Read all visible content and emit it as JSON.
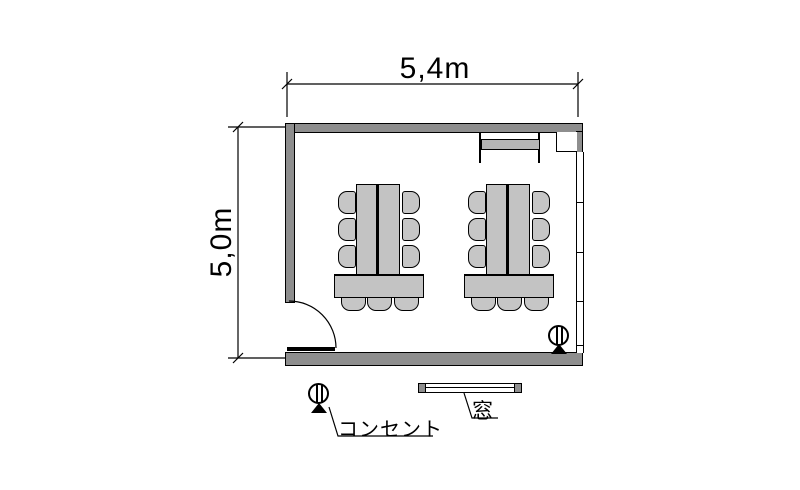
{
  "dimensions": {
    "width_label": "5,4m",
    "height_label": "5,0m"
  },
  "legend": {
    "outlet_label": "コンセント",
    "window_label": "窓"
  },
  "room": {
    "table_groups": 2,
    "chairs_per_group": 9,
    "features": [
      "door-bottom-left",
      "window-right-wall",
      "outlet-bottom-right",
      "shelf-top-right"
    ]
  },
  "colors": {
    "wall": "#8e8e8e",
    "furniture": "#c3c3c3",
    "line": "#000000",
    "background": "#ffffff"
  }
}
